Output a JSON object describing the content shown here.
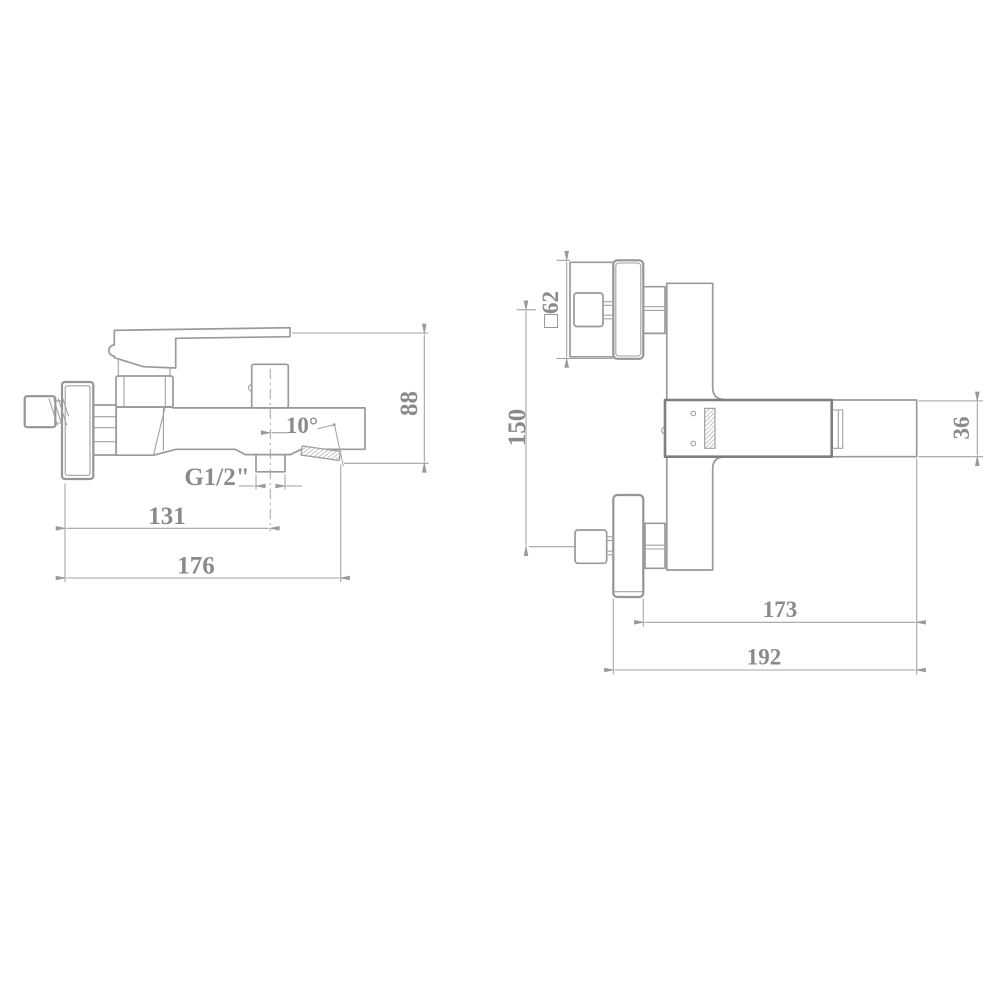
{
  "drawing": {
    "type": "technical-dimension-drawing",
    "subject": "wall-mounted bath mixer faucet, two orthographic views",
    "background_color": "#ffffff",
    "line_color": "#9a9a9a",
    "text_color": "#8a8a8a",
    "side_view": {
      "name": "side view",
      "dims": {
        "overall_height": "88",
        "wall_to_outlet_center": "131",
        "overall_length": "176",
        "outlet_thread": "G1/2\"",
        "spout_angle": "10°"
      }
    },
    "front_view": {
      "name": "front view",
      "dims": {
        "escutcheon_size": "□62",
        "port_spacing": "150",
        "body_height": "36",
        "body_to_spout_tip": "173",
        "wall_to_spout_tip": "192"
      }
    }
  }
}
